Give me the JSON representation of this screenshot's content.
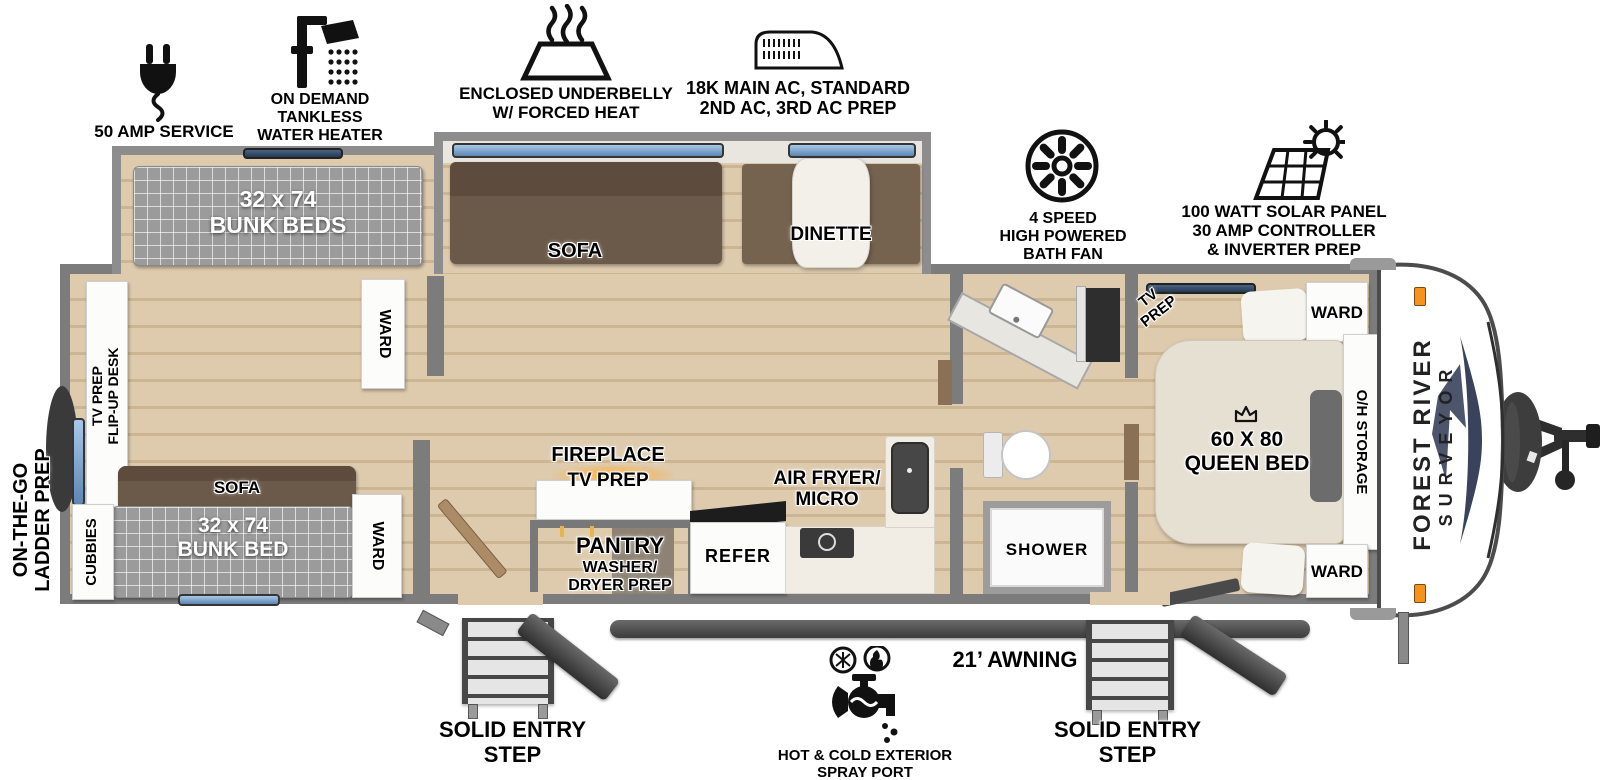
{
  "features": [
    {
      "icon": "power-plug-icon",
      "lines": [
        "50 AMP SERVICE"
      ]
    },
    {
      "icon": "shower-head-icon",
      "lines": [
        "ON DEMAND",
        "TANKLESS",
        "WATER HEATER"
      ]
    },
    {
      "icon": "underbelly-heat-icon",
      "lines": [
        "ENCLOSED UNDERBELLY",
        "W/ FORCED HEAT"
      ]
    },
    {
      "icon": "ac-unit-icon",
      "lines": [
        "18K MAIN AC, STANDARD",
        "2ND AC, 3RD AC PREP"
      ]
    },
    {
      "icon": "bath-fan-icon",
      "lines": [
        "4 SPEED",
        "HIGH POWERED",
        "BATH FAN"
      ]
    },
    {
      "icon": "solar-panel-icon",
      "lines": [
        "100 WATT SOLAR PANEL",
        "30 AMP CONTROLLER",
        "& INVERTER PREP"
      ]
    }
  ],
  "bunkhouse": {
    "slide_bunk": {
      "size": "32 x 74",
      "name": "BUNK BEDS"
    },
    "ward_top": "WARD",
    "desk": {
      "line1": "TV PREP",
      "line2": "FLIP-UP DESK"
    },
    "sofa": "SOFA",
    "bunk": {
      "size": "32 x 74",
      "name": "BUNK BED"
    },
    "cubbies": "CUBBIES",
    "ward_bottom": "WARD"
  },
  "main_slide": {
    "sofa": "SOFA",
    "dinette": "DINETTE"
  },
  "galley": {
    "fireplace": "FIREPLACE",
    "tv_prep": "TV PREP",
    "pantry": "PANTRY",
    "washer1": "WASHER/",
    "washer2": "DRYER PREP",
    "refer": "REFER",
    "airfryer1": "AIR FRYER/",
    "airfryer2": "MICRO"
  },
  "bathroom": {
    "shower": "SHOWER"
  },
  "bedroom": {
    "tv1": "TV",
    "tv2": "PREP",
    "ward_top": "WARD",
    "ward_bottom": "WARD",
    "bed_size": "60 X 80",
    "bed_name": "QUEEN BED",
    "crown_icon": "crown-icon",
    "oh_storage": "O/H STORAGE"
  },
  "exterior": {
    "ladder1": "ON-THE-GO",
    "ladder2": "LADDER PREP",
    "brand1": "FOREST RIVER",
    "brand2": "SURVEYOR",
    "awning": "21’ AWNING",
    "step_left1": "SOLID ENTRY",
    "step_left2": "STEP",
    "step_right1": "SOLID ENTRY",
    "step_right2": "STEP",
    "spray_icon": "spray-port-icon",
    "spray1": "HOT & COLD EXTERIOR",
    "spray2": "SPRAY PORT"
  },
  "colors": {
    "accent_orange": "#f6921e",
    "navy": "#39435c",
    "wall_gray": "#7c7c7c",
    "wood": "#d8c5a8",
    "window_blue": "#7aa3cf",
    "sofa_brown": "#6b5949",
    "mattress_gray": "#9b9b9b",
    "fireplace_glow": "#ffa92e"
  }
}
